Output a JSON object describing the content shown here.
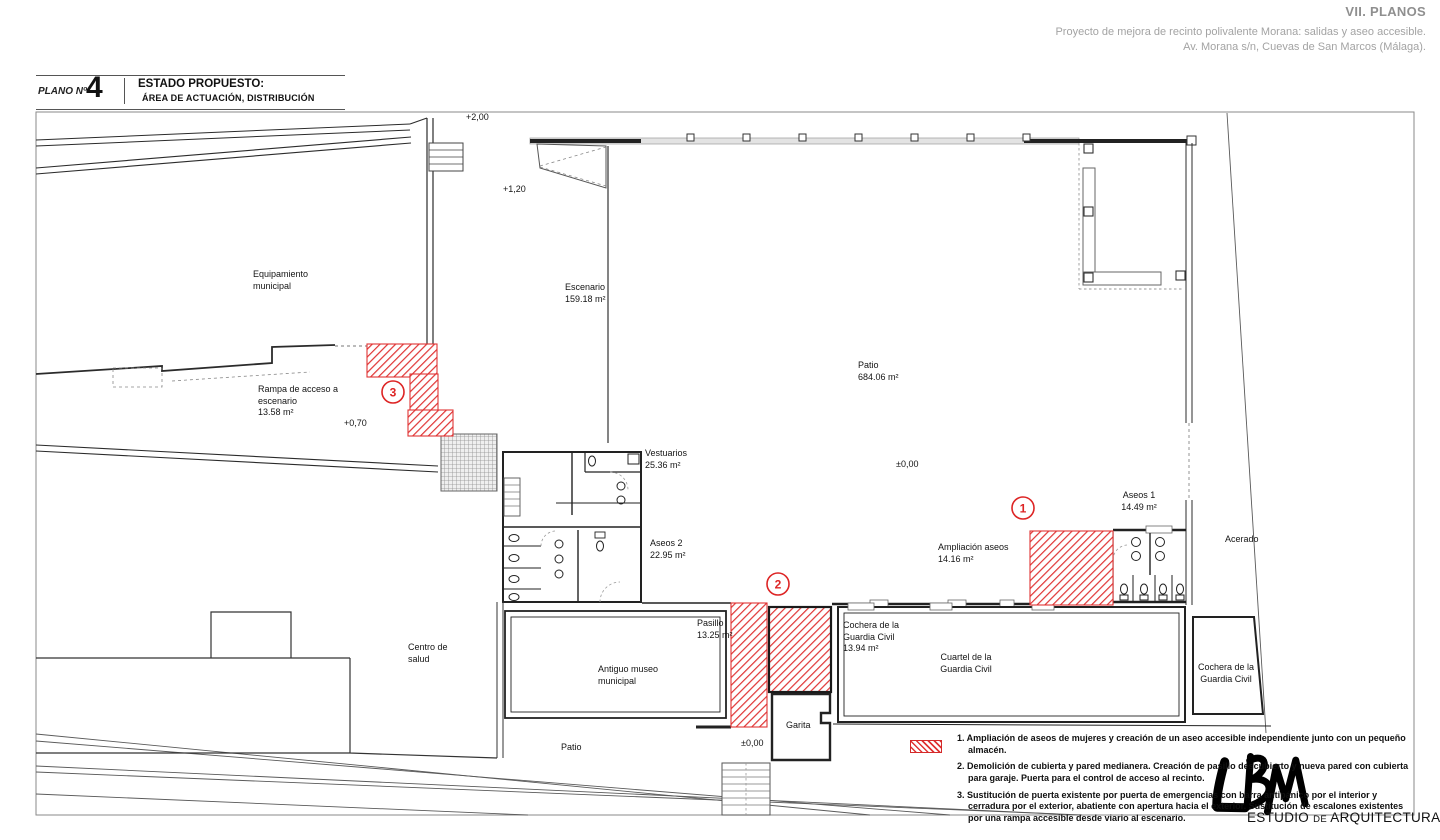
{
  "colors": {
    "highlight_red": "#e03434",
    "wall": "#2b2b2b",
    "header_gray": "#9d9d9d"
  },
  "header": {
    "section": "VII. PLANOS",
    "project_line1": "Proyecto de mejora de recinto polivalente Morana: salidas y aseo accesible.",
    "project_line2": "Av. Morana s/n, Cuevas de San Marcos (Málaga)."
  },
  "title_block": {
    "plano_label": "PLANO Nº",
    "plano_number": "4",
    "title": "ESTADO PROPUESTO:",
    "subtitle": "ÁREA DE ACTUACIÓN, DISTRIBUCIÓN"
  },
  "plan": {
    "labels": {
      "equipamiento": "Equipamiento\nmunicipal",
      "rampa": "Rampa de acceso a\nescenario\n13.58 m²",
      "escenario": "Escenario\n159.18 m²",
      "patio": "Patio\n684.06 m²",
      "vestuarios": "Vestuarios\n25.36 m²",
      "aseos2": "Aseos 2\n22.95 m²",
      "aseos1": "Aseos 1\n14.49 m²",
      "ampliacion_aseos": "Ampliación aseos\n14.16 m²",
      "acerado": "Acerado",
      "pasillo": "Pasillo\n13.25 m²",
      "museo": "Antiguo museo\nmunicipal",
      "cochera_cuartel": "Cochera de la\nGuardia Civil\n13.94 m²",
      "cuartel": "Cuartel de la\nGuardia Civil",
      "cochera_derecha": "Cochera de la\nGuardia Civil",
      "garita": "Garita",
      "centro_salud": "Centro de\nsalud",
      "patio_inferior": "Patio"
    },
    "levels": {
      "l200": "+2,00",
      "l120": "+1,20",
      "l070": "+0,70",
      "l000_patio": "±0,00",
      "l000_inferior": "±0,00"
    },
    "markers": {
      "one": "1",
      "two": "2",
      "three": "3"
    }
  },
  "legend": {
    "items": [
      {
        "text": "1. Ampliación de aseos de mujeres y creación de un aseo accesible independiente junto con un pequeño almacén."
      },
      {
        "text": "2. Demolición de cubierta y pared medianera. Creación de pasillo descubierto y nueva pared con cubierta para garaje. Puerta para el control de acceso al recinto."
      },
      {
        "text": "3. Sustitución de puerta existente por puerta de emergencias con barra antipánico por el interior y cerradura por el exterior, abatiente con apertura hacia el exterior. Sustitución de escalones existentes por una rampa accesible desde viario al escenario."
      }
    ]
  },
  "logo": {
    "studio_a": "ESTUDIO",
    "studio_b": "DE",
    "studio_c": "ARQUITECTURA"
  }
}
